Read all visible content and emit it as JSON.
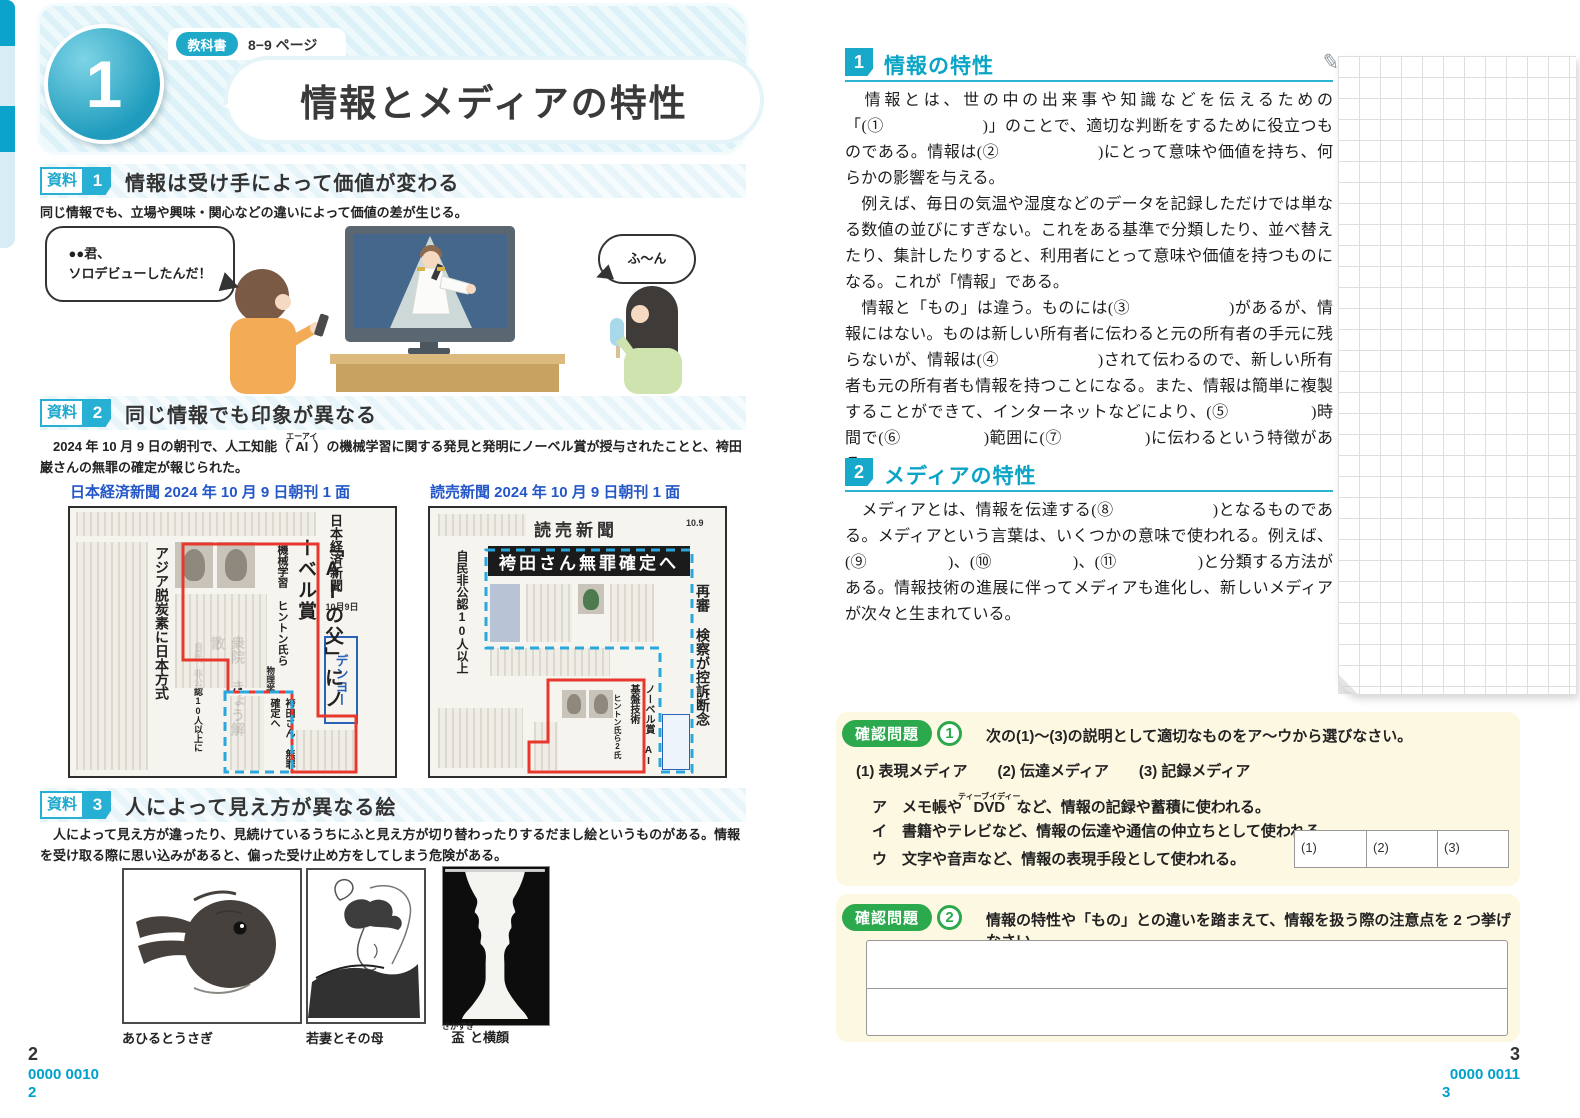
{
  "colors": {
    "accent_cyan": "#1fa9c9",
    "badge_green": "#2ca84d",
    "highlight_red": "#e8382d",
    "highlight_blue_dashed": "#2aa7dc",
    "question_bg": "#fdf8e2",
    "caption_blue": "#2356c7",
    "footer_cyan": "#00a0cc"
  },
  "icons": {
    "pencil": "✎"
  },
  "page_left": {
    "lesson_number": "1",
    "textbook_badge": "教科書",
    "textbook_pages": "8−9 ページ",
    "title": "情報とメディアの特性",
    "s1": {
      "label": "資料",
      "num": "1",
      "title": "情報は受け手によって価値が変わる",
      "subtitle": "同じ情報でも、立場や興味・関心などの違いによって価値の差が生じる。",
      "bubble_left": "●●君、\nソロデビューしたんだ！",
      "bubble_right": "ふ～ん"
    },
    "s2": {
      "label": "資料",
      "num": "2",
      "title": "同じ情報でも印象が異なる",
      "intro_pre": "　2024 年 10 月 9 日の朝刊で、人工知能（",
      "intro_ruby_base": "AI",
      "intro_ruby_text": "エーアイ",
      "intro_post": "）の機械学習に関する発見と発明にノーベル賞が授与されたことと、袴田巌さんの無罪の確定が報じられた。",
      "nikkei": {
        "caption": "日本経済新聞 2024 年 10 月 9 日朝刊 1 面",
        "masthead": "日本経済新聞",
        "date": "10月9日",
        "headline": "「AIの父」にノーベル賞",
        "subhead": "機械学習 ヒントン氏ら",
        "field": "物理学",
        "left_head": "アジア脱炭素に日本方式",
        "center_head": "衆院 きょう解散",
        "center_sub": "自民、非公認10人以上に",
        "dashed_head": "袴田さん 無罪確定へ",
        "ad": "デンヨー"
      },
      "yomiuri": {
        "caption": "読売新聞 2024 年 10 月 9 日朝刊 1 面",
        "masthead": "読売新聞",
        "date": "10.9",
        "headline": "袴田さん無罪確定へ",
        "right_head": "再審 検察が控訴断念",
        "left_head": "自民非公認10人以上",
        "red_head": "ノーベル賞 AI基盤技術",
        "red_sub": "ヒントン氏ら2氏"
      }
    },
    "s3": {
      "label": "資料",
      "num": "3",
      "title": "人によって見え方が異なる絵",
      "intro": "　人によって見え方が違ったり、見続けているうちにふと見え方が切り替わったりするだまし絵というものがある。情報を受け取る際に思い込みがあると、偏った受け止め方をしてしまう危険がある。",
      "cap1": "あひるとうさぎ",
      "cap2": "若妻とその母",
      "cap3_ruby_base": "盃",
      "cap3_ruby_text": "さかずき",
      "cap3_post": "と横顔"
    },
    "footer": {
      "page": "2",
      "code": "0000 0010",
      "code_page": "2"
    }
  },
  "page_right": {
    "sec1": {
      "num": "1",
      "title": "情報の特性",
      "p1": "　情報とは、世の中の出来事や知識などを伝えるための「(①　　　　　　)」のことで、適切な判断をするために役立つものである。情報は(②　　　　　　)にとって意味や価値を持ち、何らかの影響を与える。",
      "p2": "　例えば、毎日の気温や湿度などのデータを記録しただけでは単なる数値の並びにすぎない。これをある基準で分類したり、並べ替えたり、集計したりすると、利用者にとって意味や価値を持つものになる。これが「情報」である。",
      "p3": "　情報と「もの」は違う。ものには(③　　　　　　)があるが、情報にはない。ものは新しい所有者に伝わると元の所有者の手元に残らないが、情報は(④　　　　　　)されて伝わるので、新しい所有者も元の所有者も情報を持つことになる。また、情報は簡単に複製することができて、インターネットなどにより、(⑤　　　　　)時間で(⑥　　　　　)範囲に(⑦　　　　　)に伝わるという特徴がある。"
    },
    "sec2": {
      "num": "2",
      "title": "メディアの特性",
      "p1": "　メディアとは、情報を伝達する(⑧　　　　　　)となるものである。メディアという言葉は、いくつかの意味で使われる。例えば、(⑨　　　　　)、(⑩　　　　　)、(⑪　　　　　)と分類する方法がある。情報技術の進展に伴ってメディアも進化し、新しいメディアが次々と生まれている。"
    },
    "q1": {
      "badge": "確認問題",
      "num": "1",
      "prompt": "次の(1)～(3)の説明として適切なものをア～ウから選びなさい。",
      "items_line": "(1) 表現メディア　　(2) 伝達メディア　　(3) 記録メディア",
      "opt_a_label": "ア",
      "opt_a_pre": "メモ帳や",
      "opt_a_ruby_base": "DVD",
      "opt_a_ruby_text": "ティーブイディー",
      "opt_a_post": "など、情報の記録や蓄積に使われる。",
      "opt_b_label": "イ",
      "opt_b_text": "書籍やテレビなど、情報の伝達や通信の仲立ちとして使われる。",
      "opt_c_label": "ウ",
      "opt_c_text": "文字や音声など、情報の表現手段として使われる。",
      "answer_labels": [
        "(1)",
        "(2)",
        "(3)"
      ]
    },
    "q2": {
      "badge": "確認問題",
      "num": "2",
      "prompt": "情報の特性や「もの」との違いを踏まえて、情報を扱う際の注意点を 2 つ挙げなさい。"
    },
    "footer": {
      "page": "3",
      "code": "0000 0011",
      "code_page": "3"
    }
  }
}
